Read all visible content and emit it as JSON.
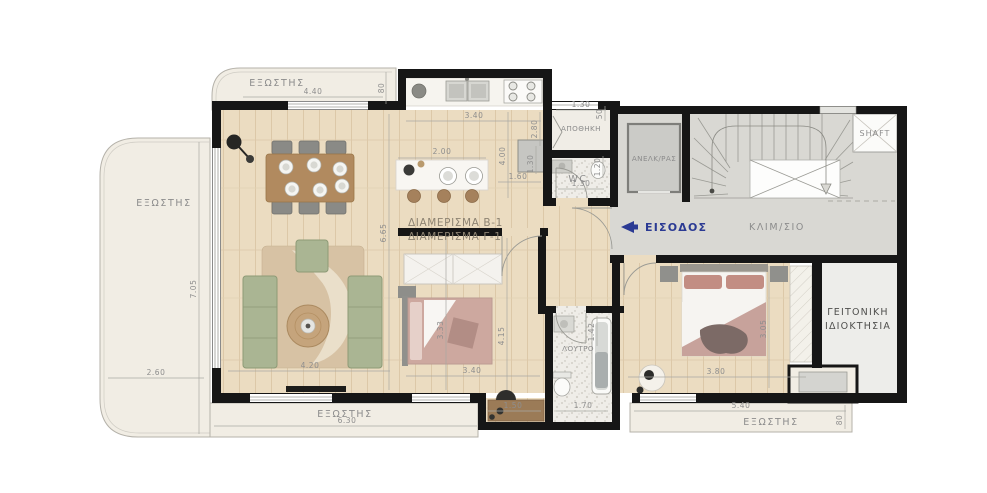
{
  "title": "Apartment floor plan B-1 / Γ-1",
  "labels": {
    "balcony": "ΕΞΩΣΤΗΣ",
    "storage": "ΑΠΟΘΗΚΗ",
    "wc": "WC",
    "elevator": "ΑΝΕΛΚ/ΡΑΣ",
    "stairs": "ΚΛΙΜ/ΣΙΟ",
    "entrance": "ΕΙΣΟΔΟΣ",
    "bathroom": "ΛΟΥΤΡΟ",
    "shaft": "SHAFT",
    "neighbor1": "ΓΕΙΤΟΝΙΚΗ",
    "neighbor2": "ΙΔΙΟΚΤΗΣΙΑ",
    "apartment_b": "ΔΙΑΜΕΡΙΣΜΑ Β-1",
    "apartment_c": "ΔΙΑΜΕΡΙΣΜΑ Γ-1"
  },
  "dims": {
    "balcony_top_w": "4.40",
    "balcony_top_d": "80",
    "kitchen_counter": "3.40",
    "kitchen_depth": "2.80",
    "storage_w": "1.30",
    "storage_d": "50",
    "island_w": "2.00",
    "kitchen_len": "4.00",
    "island_aisle": "1.60",
    "fridge_w": "1.30",
    "wc_w": "1.30",
    "wc_d": "1.20",
    "living_len": "6.65",
    "living_w": "4.20",
    "balcony_left_len": "7.05",
    "balcony_left_w": "2.60",
    "balcony_bottom_len": "6.30",
    "bedroom1_w": "3.33",
    "bedroom1_len": "4.15",
    "bedroom1_w2": "3.40",
    "nook_w": "1.50",
    "bath_w": "1.70",
    "bath_d": "1.42",
    "bedroom2_w": "3.80",
    "bedroom2_d": "3.05",
    "balcony_br_len": "5.40",
    "balcony_br_d": "80"
  },
  "colors": {
    "wall": "#161616",
    "wood_floor": "#ebdcc1",
    "balcony": "#f1ede4",
    "commons": "#d9d8d3",
    "terrazzo": "#efede8",
    "sofa_green": "#aab593",
    "bed_mauve": "#c7a29b",
    "entrance_blue": "#2b3a93",
    "dim_text": "#8e8e8e"
  }
}
